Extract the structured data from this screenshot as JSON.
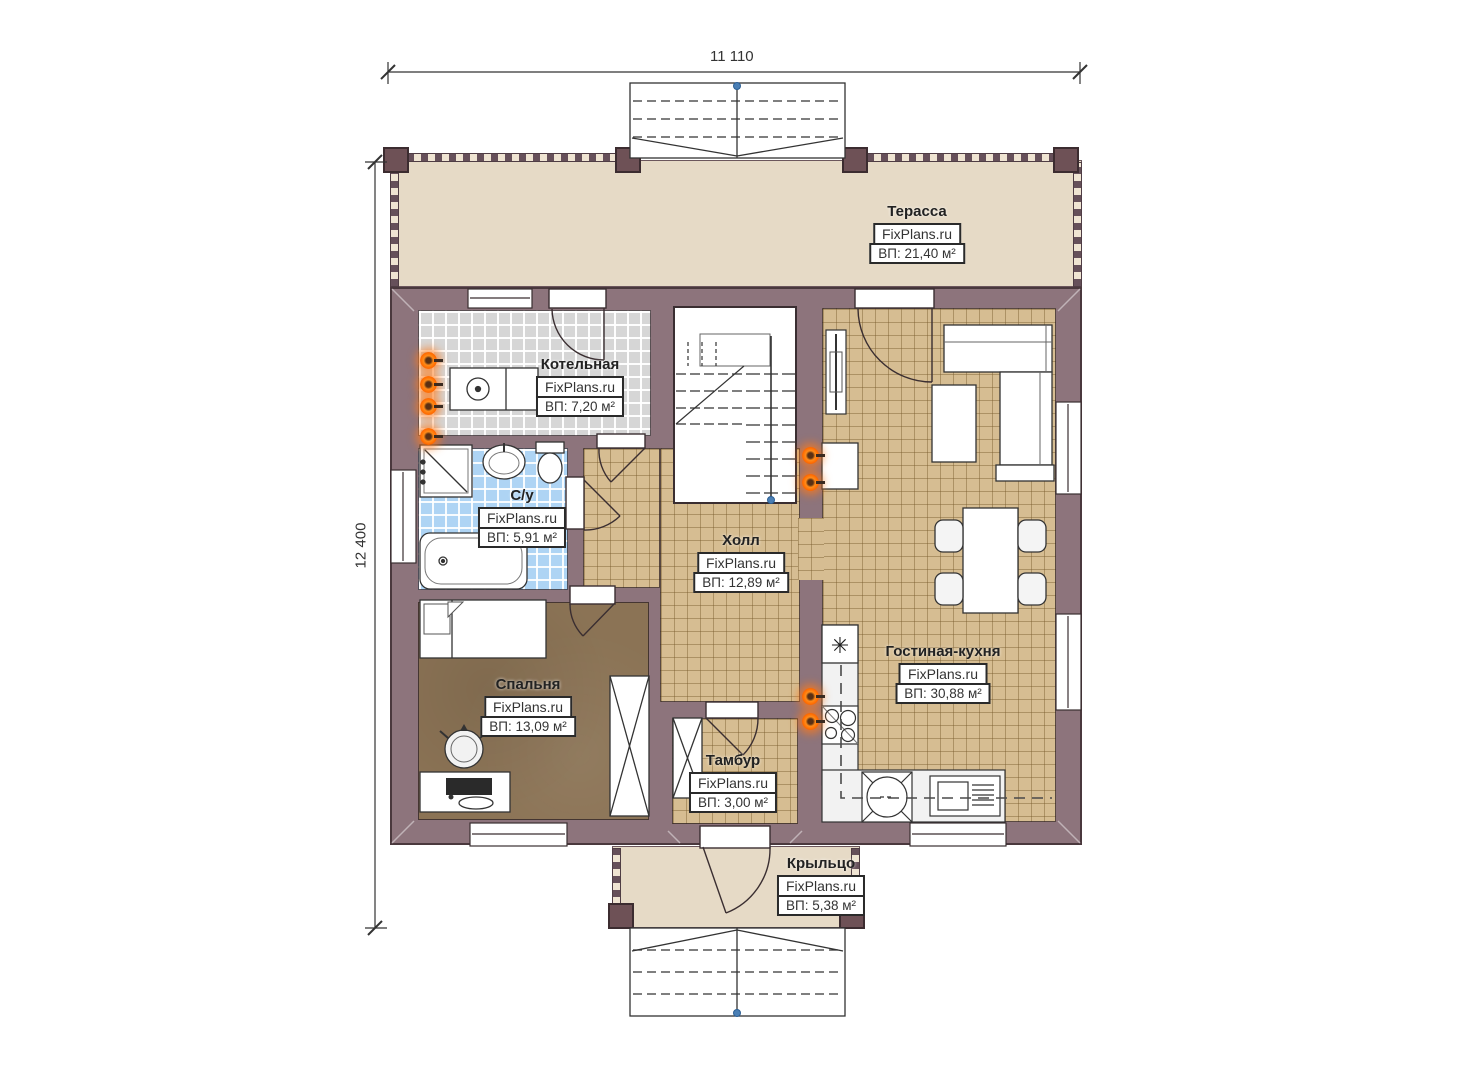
{
  "watermark": "FixPlans.ru",
  "dimensions": {
    "width_mm": "11 110",
    "height_mm": "12 400"
  },
  "rooms": [
    {
      "key": "terrace",
      "name": "Терасса",
      "area": "ВП: 21,40 м²"
    },
    {
      "key": "boiler",
      "name": "Котельная",
      "area": "ВП: 7,20 м²"
    },
    {
      "key": "bathroom",
      "name": "С/у",
      "area": "ВП: 5,91 м²"
    },
    {
      "key": "hall",
      "name": "Холл",
      "area": "ВП: 12,89 м²"
    },
    {
      "key": "living-kitchen",
      "name": "Гостиная-кухня",
      "area": "ВП: 30,88 м²"
    },
    {
      "key": "bedroom",
      "name": "Спальня",
      "area": "ВП: 13,09 м²"
    },
    {
      "key": "vestibule",
      "name": "Тамбур",
      "area": "ВП: 3,00 м²"
    },
    {
      "key": "porch",
      "name": "Крыльцо",
      "area": "ВП: 5,38 м²"
    }
  ],
  "icons": {
    "freezer": "✳"
  },
  "colors": {
    "wall": "#8d747c",
    "terrace_floor": "#e6dac6",
    "tile_beige": "#d6bd92",
    "tile_gray": "#d6d6d6",
    "tile_blue": "#aed4f4",
    "bedroom_floor": "#8b7355",
    "radiator_orange": "#ff6a00",
    "marker_blue": "#4a7fb5"
  }
}
